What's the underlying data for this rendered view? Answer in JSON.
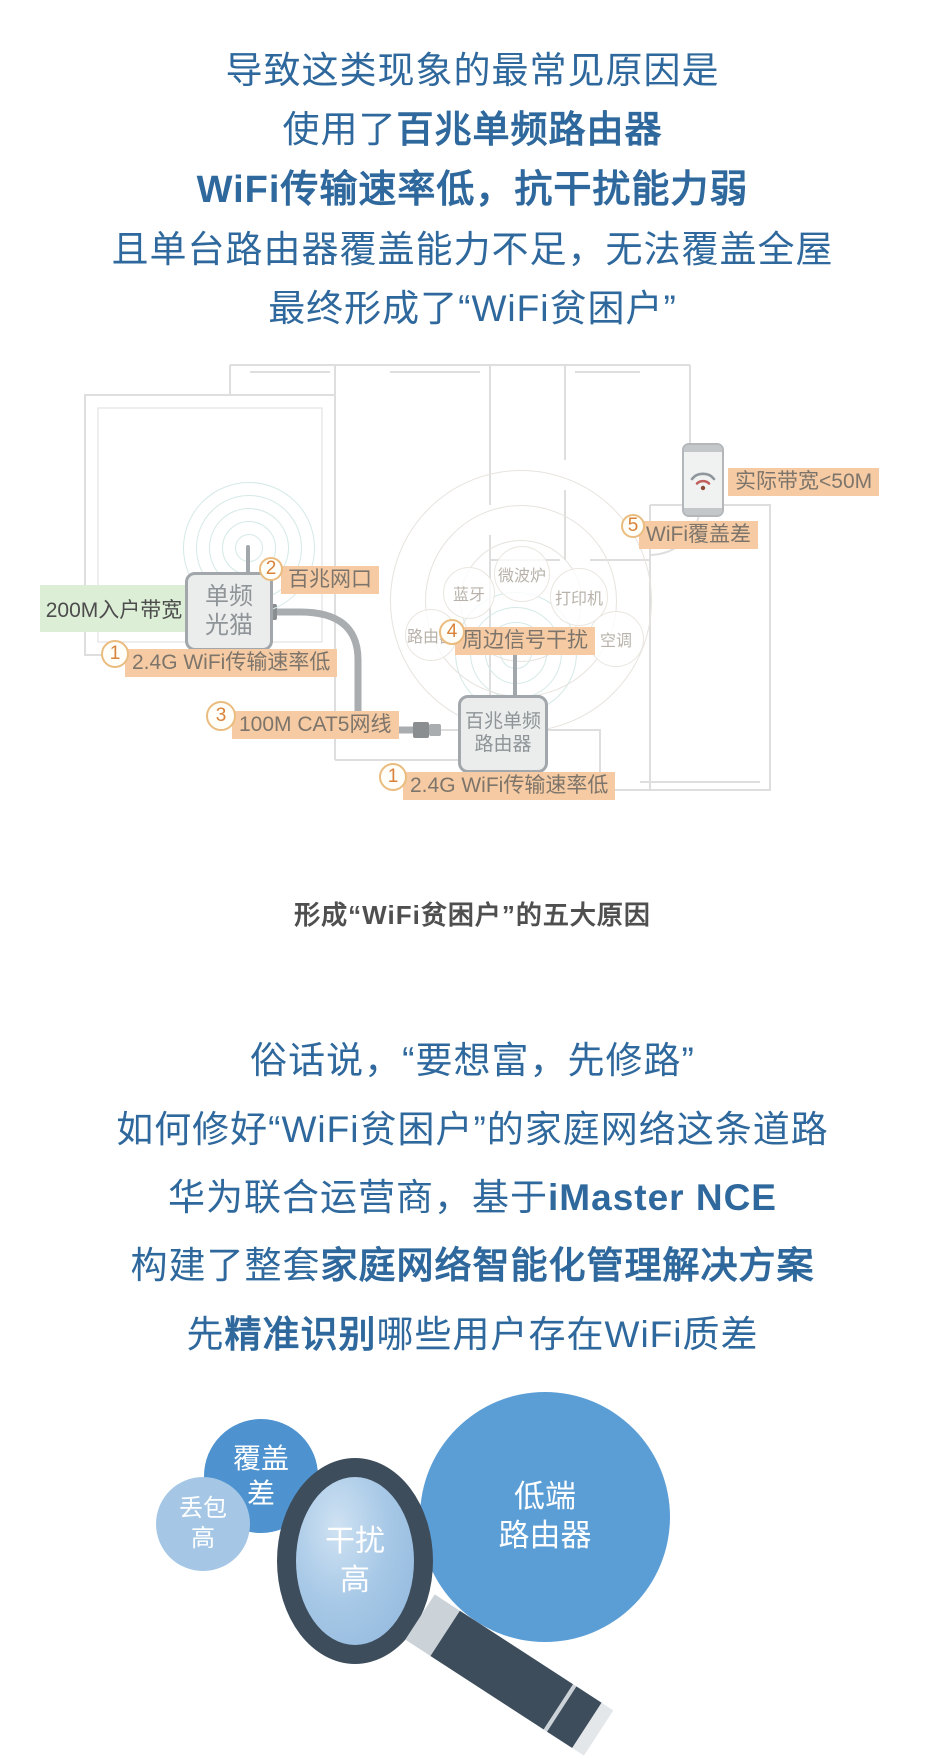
{
  "intro": {
    "line1": "导致这类现象的最常见原因是",
    "line2_pre": "使用了",
    "line2_bold": "百兆单频路由器",
    "line3_bold": "WiFi传输速率低，抗干扰能力弱",
    "line4": "且单台路由器覆盖能力不足，无法覆盖全屋",
    "line5": "最终形成了“WiFi贫困户”"
  },
  "diagram": {
    "bandwidth_label": "200M入户带宽",
    "modem_line1": "单频",
    "modem_line2": "光猫",
    "router_line1": "百兆单频",
    "router_line2": "路由器",
    "phone_label": "实际带宽<50M",
    "badges": {
      "b1": {
        "num": "1",
        "text": "2.4G WiFi传输速率低"
      },
      "b2": {
        "num": "2",
        "text": "百兆网口"
      },
      "b3": {
        "num": "3",
        "text": "100M CAT5网线"
      },
      "b4": {
        "num": "4",
        "text": "周边信号干扰"
      },
      "b5": {
        "num": "5",
        "text": "WiFi覆盖差"
      }
    },
    "interference_sources": [
      "蓝牙",
      "微波炉",
      "打印机",
      "路由器",
      "空调"
    ],
    "caption": "形成“WiFi贫困户”的五大原因"
  },
  "solution": {
    "line1": "俗话说，“要想富，先修路”",
    "line2": "如何修好“WiFi贫困户”的家庭网络这条道路",
    "line3_pre": "华为联合运营商，基于",
    "line3_bold": "iMaster NCE",
    "line4_pre": "构建了整套",
    "line4_bold": "家庭网络智能化管理解决方案",
    "line5_pre": "先",
    "line5_bold": "精准识别",
    "line5_post": "哪些用户存在WiFi质差"
  },
  "bubbles": {
    "packet_loss_line1": "丢包",
    "packet_loss_line2": "高",
    "coverage_line1": "覆盖",
    "coverage_line2": "差",
    "interference_line1": "干扰",
    "interference_line2": "高",
    "router_line1": "低端",
    "router_line2": "路由器"
  },
  "icons": {
    "arrow_right": "➜"
  },
  "colors": {
    "body_text_blue": "#2e689c",
    "badge_bg": "#f6cba3",
    "badge_number_orange": "#d8823a",
    "bandwidth_green_bg": "#ddeed7",
    "caption_gray": "#4f4f4f",
    "bubble_light_blue": "#a5c7e5",
    "bubble_medium_blue": "#4e93cf",
    "magnifier_dark": "#3d4d5c"
  }
}
